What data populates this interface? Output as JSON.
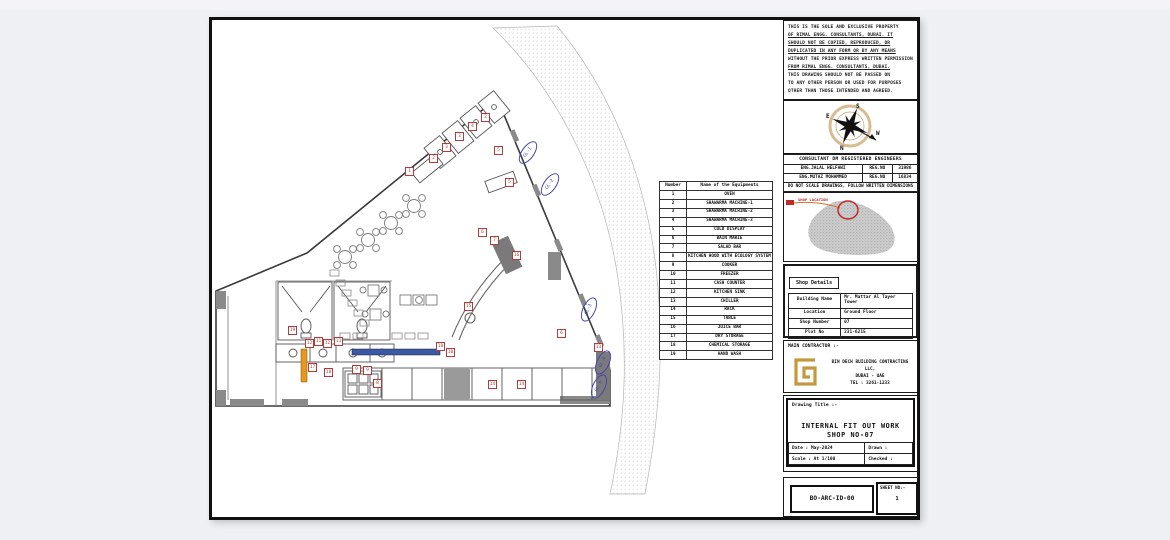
{
  "window": {
    "background": "#eef0f4"
  },
  "disclaimer": {
    "lines": [
      "THIS IS THE SOLE AND EXCLUSIVE PROPERTY",
      "OF RIMAL ENGG. CONSULTANTS, DUBAI. IT",
      "SHOULD NOT BE COPIED, REPRODUCED, OR",
      "DUPLICATED IN ANY FORM OR BY ANY MEANS",
      "WITHOUT THE PRIOR EXPRESS WRITTEN PERMISSION",
      "FROM RIMAL ENGG. CONSULTANTS, DUBAI.",
      "THIS DRAWING SHOULD NOT BE PASSED ON",
      "TO ANY OTHER PERSON OR USED FOR PURPOSES",
      "OTHER THAN THOSE INTENDED AND AGREED."
    ],
    "underlined": [
      1,
      2,
      3,
      5
    ]
  },
  "compass": {
    "top": "S",
    "left": "E",
    "bottom": "N",
    "right": "W"
  },
  "consultant": {
    "header": "CONSULTANT DM REGISTERED ENGINEERS",
    "engineers": [
      {
        "name": "ENG.JALAL HELFAWI",
        "reg_label": "REG.NO",
        "reg_no": "31986"
      },
      {
        "name": "ENG.MUTAZ MOHAMMED",
        "reg_label": "REG.NO",
        "reg_no": "16834"
      }
    ],
    "note": "DO NOT SCALE DRAWINGS, FOLLOW WRITTEN DIMENSIONS"
  },
  "location_map": {
    "label": "SHOP LOCATION"
  },
  "shop_details": {
    "title": "Shop Details",
    "rows": [
      {
        "label": "Building Name",
        "value": "Mr. Mattar Al Tayer Tower"
      },
      {
        "label": "Location",
        "value": "Ground Floor"
      },
      {
        "label": "Shop Number",
        "value": "07"
      },
      {
        "label": "Plot No",
        "value": "231-6215"
      }
    ]
  },
  "contractor": {
    "label": "MAIN CONTRACTOR :-",
    "line1": "BIN DECH BUILDING CONTRACTING LLC,",
    "line2": "DUBAI - UAE",
    "line3": "TEL : 3261-1233"
  },
  "drawing_title": {
    "label": "Drawing Title :-",
    "line1": "INTERNAL FIT OUT WORK",
    "line2": "SHOP NO-07",
    "date": "Date : May-2024",
    "drawn": "Drawn :",
    "scale": "Scale : At 1/100",
    "checked": "Checked :"
  },
  "sheet_id": {
    "code": "BO-ARC-ID-00",
    "sheet_no_label": "SHEET NO:-",
    "sheet_no": "1"
  },
  "equipment_table": {
    "headers": [
      "Number",
      "Name of the Equipments"
    ],
    "rows": [
      [
        "1",
        "OVEN"
      ],
      [
        "2",
        "SHAWARMA MACHINE-1"
      ],
      [
        "3",
        "SHAWARMA MACHINE-2"
      ],
      [
        "4",
        "SHAWARMA MACHINE-3"
      ],
      [
        "5",
        "COLD DISPLAY"
      ],
      [
        "6",
        "BAIN MARIE"
      ],
      [
        "7",
        "SALAD BAR"
      ],
      [
        "8",
        "KITCHEN HOOD WITH ECOLOGY SYSTEM"
      ],
      [
        "9",
        "COOKER"
      ],
      [
        "10",
        "FREEZER"
      ],
      [
        "11",
        "CASH COUNTER"
      ],
      [
        "12",
        "KITCHEN SINK"
      ],
      [
        "13",
        "CHILLER"
      ],
      [
        "14",
        "RACK"
      ],
      [
        "15",
        "TABLE"
      ],
      [
        "16",
        "JUICE BAR"
      ],
      [
        "17",
        "DRY STORAGE"
      ],
      [
        "18",
        "CHEMICAL STORAGE"
      ],
      [
        "19",
        "HAND WASH"
      ]
    ]
  },
  "plan": {
    "colors": {
      "tag_red": "#b23b3b",
      "cloud_blue": "#4444b2",
      "counter_blue": "#3b57a8",
      "accent_orange": "#e8971e",
      "wall_gray": "#8a8a8a",
      "hatch_dot": "#c9c9c9",
      "compass_tan": "#d8bb90",
      "logo_gold": "#c3993d",
      "map_red": "#c22a2a"
    },
    "tags": [
      {
        "n": "1",
        "x": 409,
        "y": 171
      },
      {
        "n": "2",
        "x": 433,
        "y": 158
      },
      {
        "n": "3",
        "x": 446,
        "y": 147
      },
      {
        "n": "3",
        "x": 459,
        "y": 136
      },
      {
        "n": "4",
        "x": 472,
        "y": 126
      },
      {
        "n": "2",
        "x": 485,
        "y": 117
      },
      {
        "n": "5",
        "x": 498,
        "y": 150
      },
      {
        "n": "5",
        "x": 509,
        "y": 182
      },
      {
        "n": "6",
        "x": 482,
        "y": 232
      },
      {
        "n": "7",
        "x": 494,
        "y": 240
      },
      {
        "n": "16",
        "x": 516,
        "y": 255
      },
      {
        "n": "15",
        "x": 468,
        "y": 306
      },
      {
        "n": "19",
        "x": 292,
        "y": 330
      },
      {
        "n": "12",
        "x": 309,
        "y": 343
      },
      {
        "n": "11",
        "x": 318,
        "y": 341
      },
      {
        "n": "12",
        "x": 327,
        "y": 343
      },
      {
        "n": "13",
        "x": 338,
        "y": 341
      },
      {
        "n": "17",
        "x": 312,
        "y": 367
      },
      {
        "n": "18",
        "x": 328,
        "y": 372
      },
      {
        "n": "9",
        "x": 356,
        "y": 369
      },
      {
        "n": "9",
        "x": 367,
        "y": 370
      },
      {
        "n": "8",
        "x": 377,
        "y": 383
      },
      {
        "n": "10",
        "x": 440,
        "y": 346
      },
      {
        "n": "10",
        "x": 450,
        "y": 352
      },
      {
        "n": "14",
        "x": 492,
        "y": 384
      },
      {
        "n": "14",
        "x": 521,
        "y": 384
      },
      {
        "n": "6",
        "x": 561,
        "y": 333
      },
      {
        "n": "13",
        "x": 598,
        "y": 347
      }
    ],
    "clouds": [
      {
        "label": "GL-1",
        "x": 527,
        "y": 152,
        "rot": -55
      },
      {
        "label": "GL-2",
        "x": 549,
        "y": 184,
        "rot": -55
      },
      {
        "label": "GL-3",
        "x": 588,
        "y": 309,
        "rot": -65
      },
      {
        "label": "GL-4",
        "x": 602,
        "y": 362,
        "rot": -65
      },
      {
        "label": "GL-5",
        "x": 598,
        "y": 386,
        "rot": -65
      }
    ]
  }
}
